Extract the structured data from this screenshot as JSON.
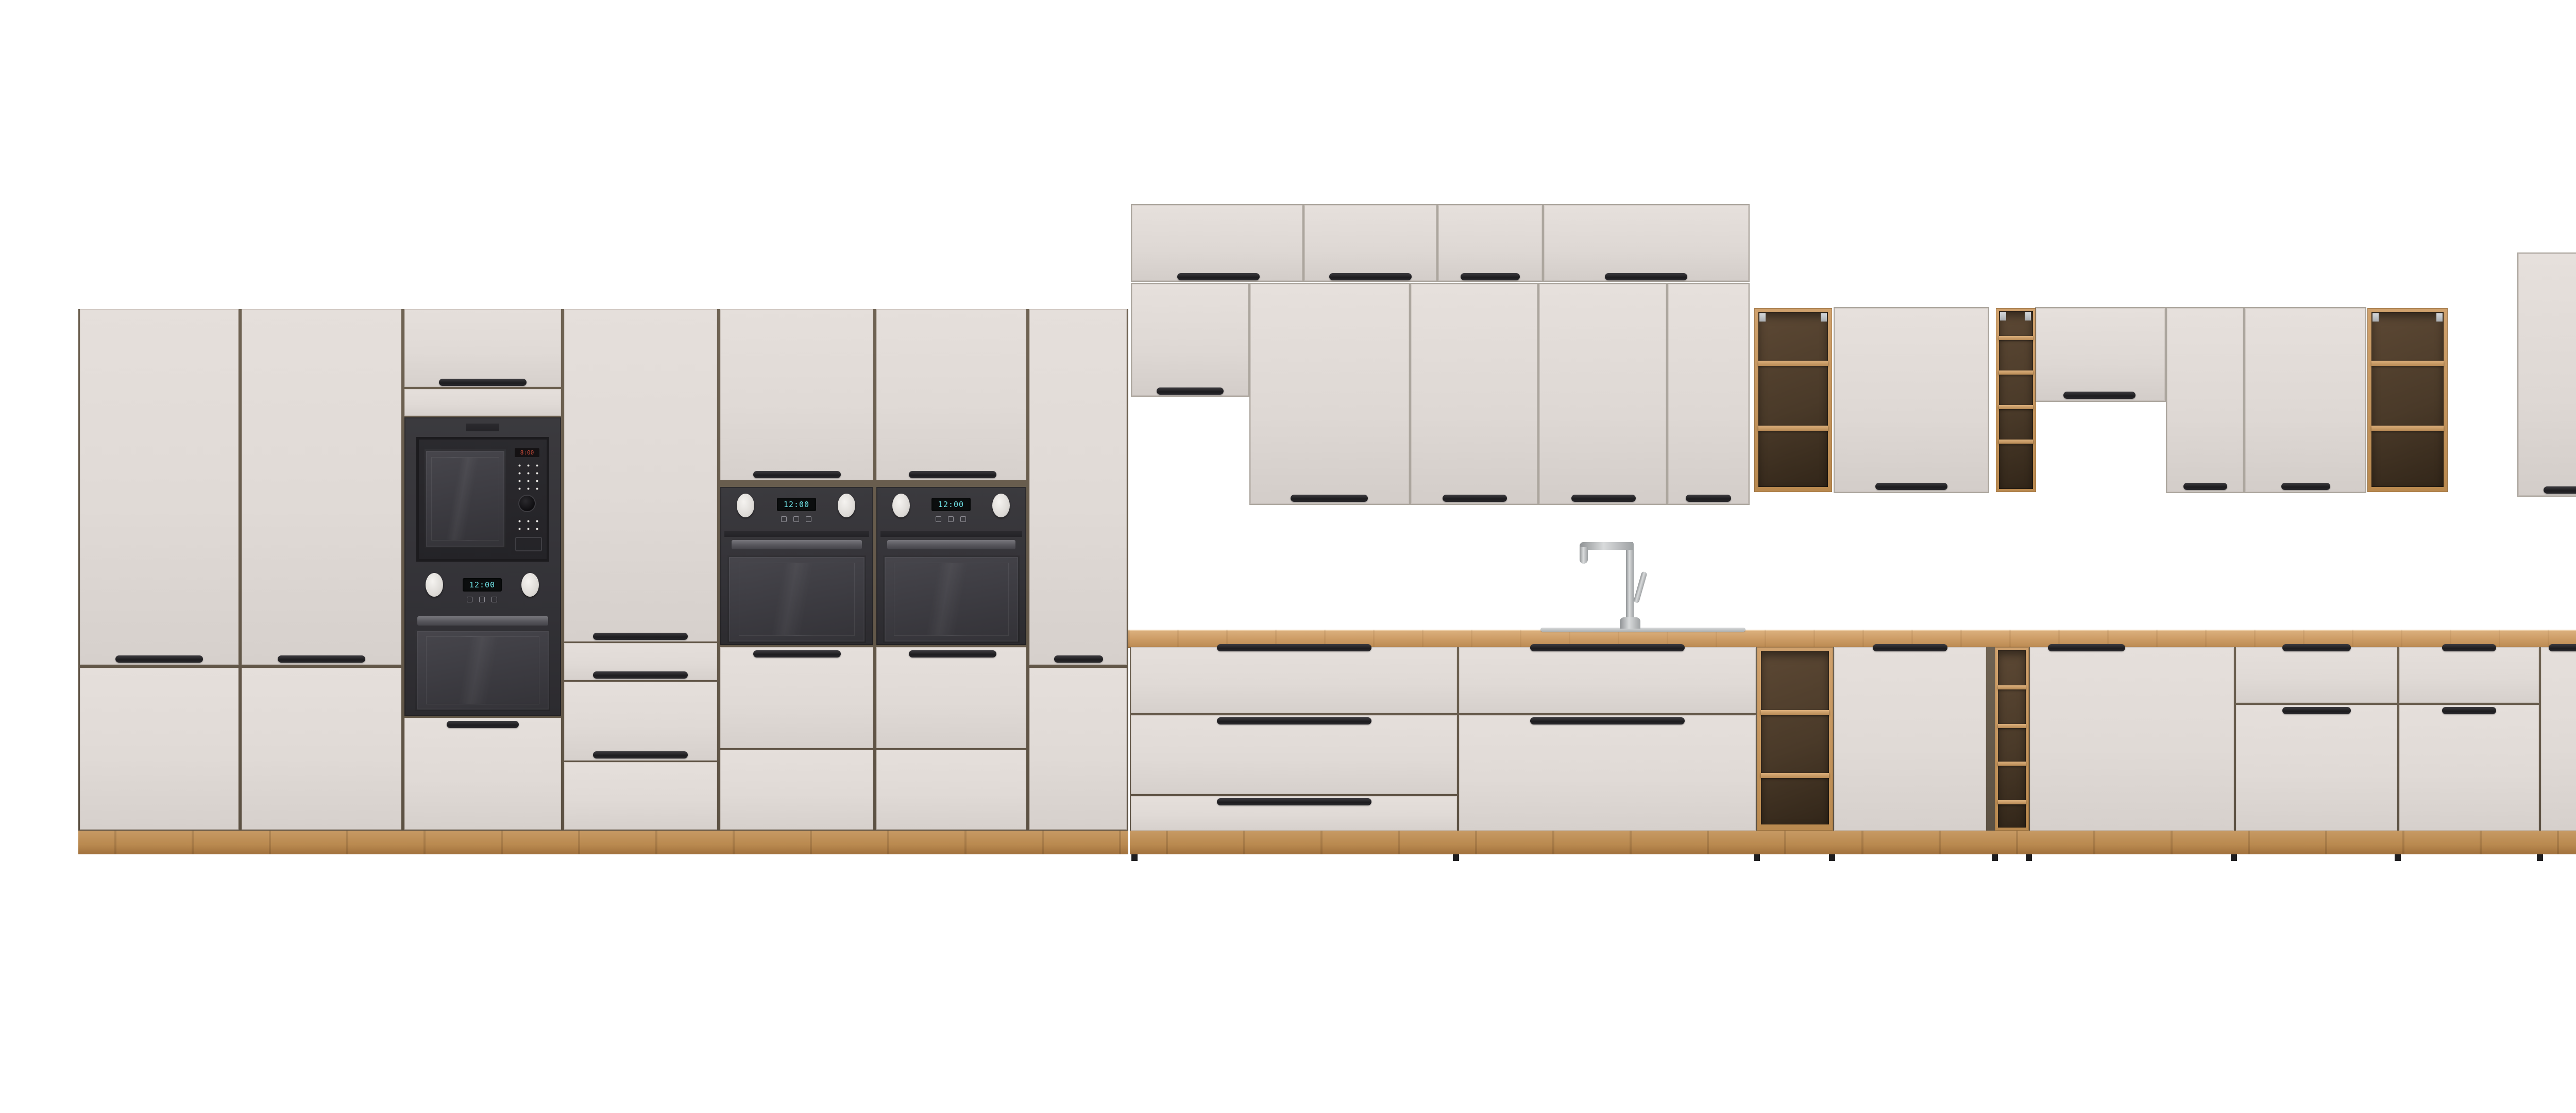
{
  "page": {
    "background": "#ffffff",
    "subject": "modular-kitchen-cabinet-lineup-product-render"
  },
  "palette": {
    "bg": "#ffffff",
    "front": "#e2dcd8",
    "carcass": "#6a5f52",
    "wood": "#c89a64",
    "wood_deep": "#aa7c47",
    "interior_dark": "#4a3a29",
    "appliance_dark": "#37363a",
    "glass": "#403f45",
    "steel": "#b8babc",
    "dw_panel": "#d6d0cb",
    "knob_white": "#eeebe8",
    "handle_black": "#262528",
    "display_cyan": "#71e6ea",
    "display_red": "#d8503e",
    "sink_steel": "#c6c8c9"
  },
  "appliances": {
    "microwave_display": "8:00",
    "tower_oven_display": "12:00",
    "wall_oven_left_display": "12:00",
    "wall_oven_right_display": "12:00",
    "base_oven_display": "12:00"
  }
}
